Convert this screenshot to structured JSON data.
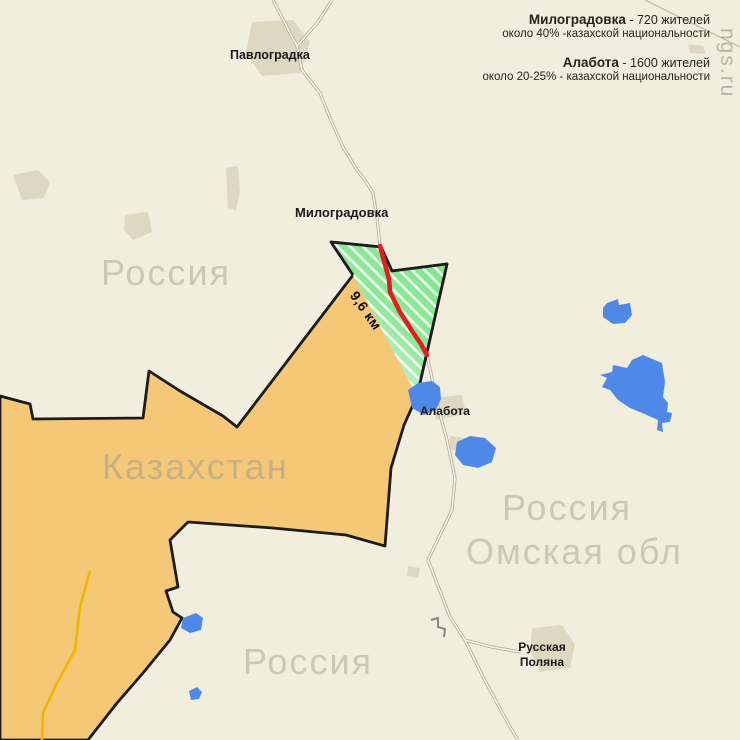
{
  "infobox": {
    "l1_bold": "Милоградовка",
    "l1_rest": " - 720 жителей",
    "l2": "около 40% -казахской национальности",
    "l3_bold": "Алабота",
    "l3_rest": " - 1600 жителей",
    "l4": "около 20-25% - казахской национальности"
  },
  "labels": {
    "pavlogradka": "Павлоградка",
    "milogradovka": "Милоградовка",
    "alabota": "Алабота",
    "russia_nw": "Россия",
    "kazakhstan": "Казахстан",
    "russia_e": "Россия",
    "omsk_oblast": "Омская обл",
    "russia_s": "Россия",
    "russkaya_polyana": "Русская Поляна",
    "distance": "9,6 км",
    "watermark": "ngs.ru"
  },
  "colors": {
    "background": "#f1eedd",
    "settlement": "#ded7c1",
    "kazakhstan": "#f5c878",
    "border_line": "#1c1c1c",
    "disputed_green": "#8fe89a",
    "disputed_green_pale": "#e6f7e3",
    "hatch": "#ffffff",
    "red_road": "#e02020",
    "lake": "#4f89e8",
    "road_casing": "#b3ac97",
    "road_fill": "#faf8ec",
    "track": "#c0b7a0",
    "yellow_road": "#f0b501",
    "region_label": "#ccc8b6",
    "kazakh_label": "#c8b084",
    "town_label": "#1a1a1a",
    "info_text": "#27241a",
    "watermark": "#8a8878"
  }
}
